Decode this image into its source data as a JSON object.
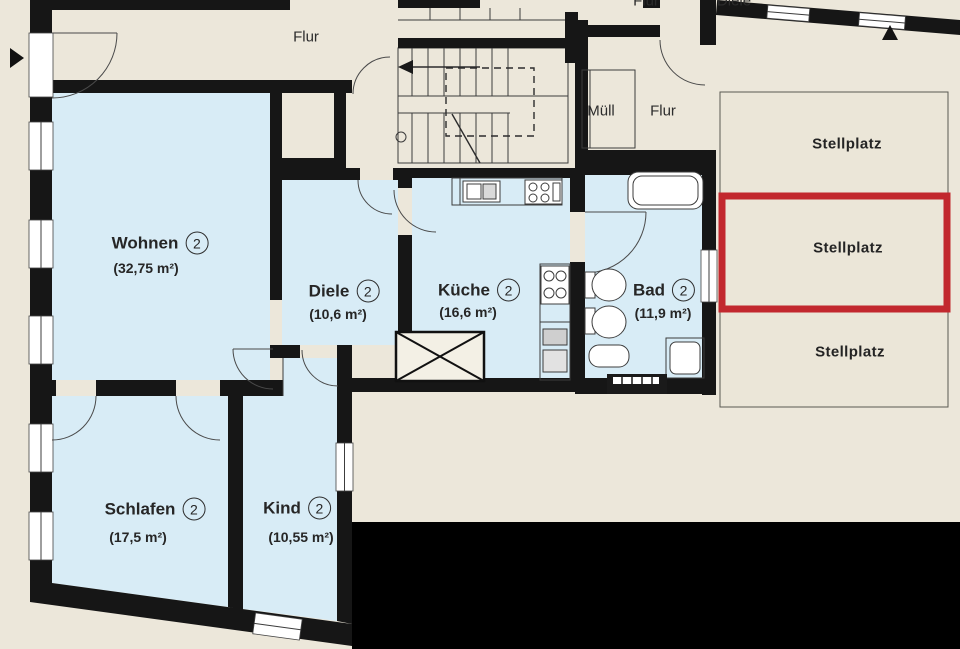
{
  "rooms": {
    "wohnen": {
      "name": "Wohnen",
      "number": "2",
      "area": "(32,75 m²)"
    },
    "diele": {
      "name": "Diele",
      "number": "2",
      "area": "(10,6 m²)"
    },
    "kueche": {
      "name": "Küche",
      "number": "2",
      "area": "(16,6 m²)"
    },
    "bad": {
      "name": "Bad",
      "number": "2",
      "area": "(11,9 m²)"
    },
    "schlafen": {
      "name": "Schlafen",
      "number": "2",
      "area": "(17,5 m²)"
    },
    "kind": {
      "name": "Kind",
      "number": "2",
      "area": "(10,55 m²)"
    }
  },
  "halls": {
    "flur_entry": "Flur",
    "muell": "Müll",
    "flur_stairwell": "Flur",
    "flur_top_cut": "Flur",
    "diele_top_cut": "Diele"
  },
  "parking": {
    "spot_1": "Stellplatz",
    "spot_2": "Stellplatz",
    "spot_3": "Stellplatz"
  },
  "colors": {
    "background": "#ece7da",
    "room_fill": "#d8ecf6",
    "wall": "#161616",
    "line": "#3c3c3c",
    "highlight_red": "#c2282e",
    "censor_black": "#000000"
  }
}
